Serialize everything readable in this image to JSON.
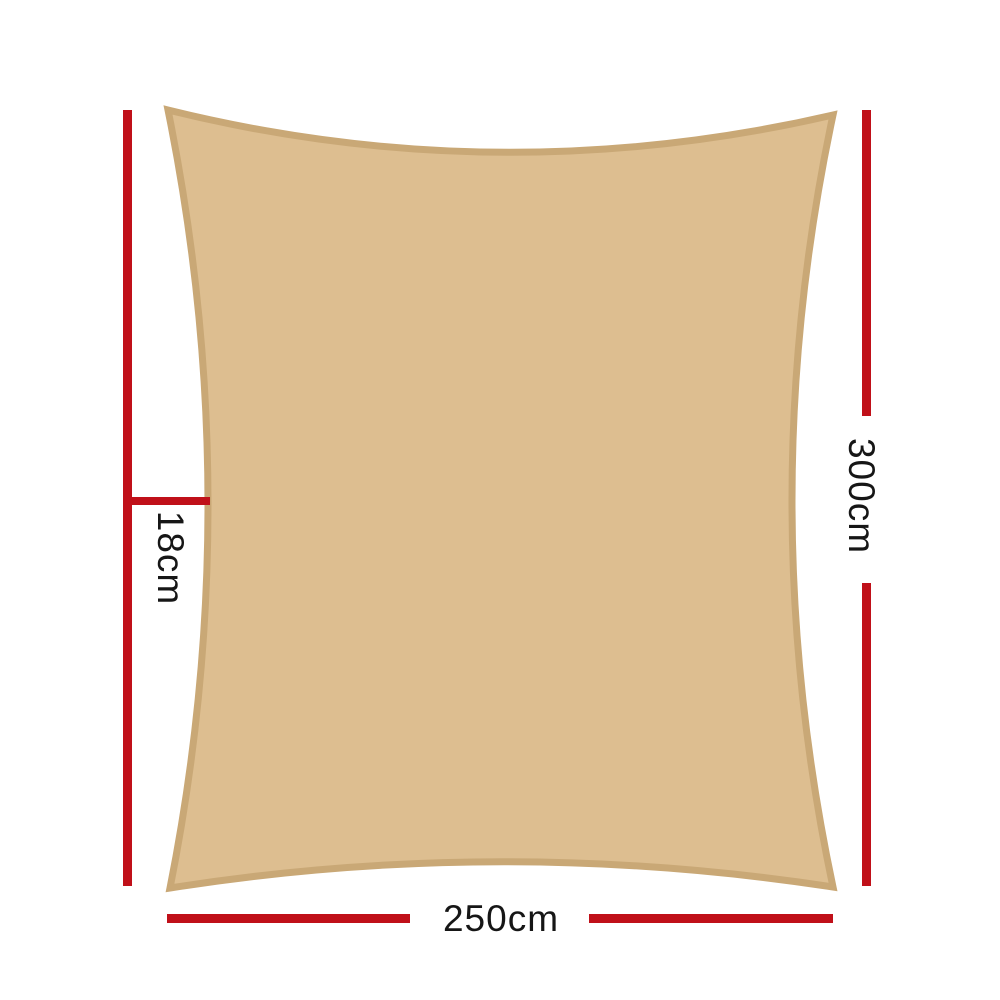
{
  "page": {
    "description": "Shade sail product dimensions diagram",
    "background": "#ffffff"
  },
  "colors": {
    "sail_fill": "#ddbe90",
    "sail_border": "#c9a876",
    "dimension_line": "#c01019",
    "label_text": "#161616"
  },
  "sail": {
    "name": "rectangle shade sail",
    "shape": "rectangle with concave edges"
  },
  "dimensions": {
    "side_height": {
      "label": "300cm",
      "position": "right"
    },
    "bottom_width": {
      "label": "250cm",
      "position": "bottom"
    },
    "curve_depth": {
      "label": "18cm",
      "position": "left"
    }
  }
}
